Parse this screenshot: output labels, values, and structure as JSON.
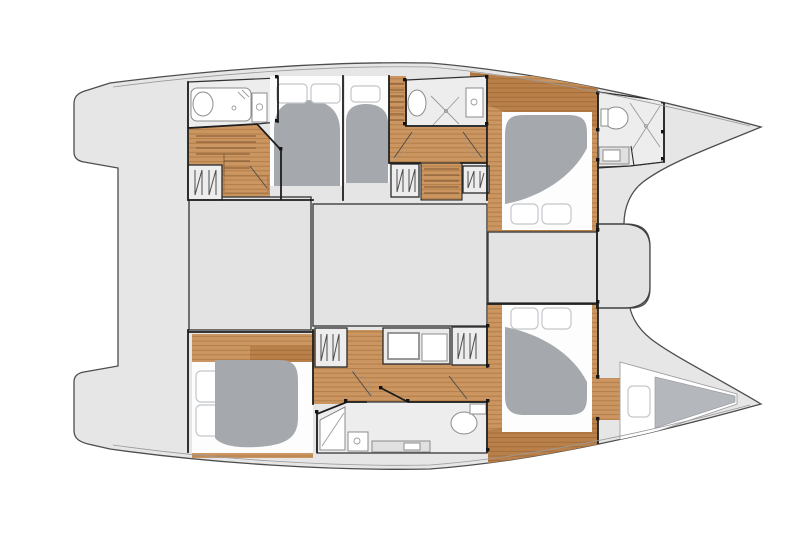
{
  "canvas": {
    "width": 800,
    "height": 533,
    "background": "#ffffff"
  },
  "diagram": {
    "type": "floor-plan",
    "subject": "catamaran yacht interior layout, top view, no text labels",
    "text_labels": [],
    "areas": {
      "bridgedeck": [
        "aft-platform",
        "salon-block-left",
        "salon-block-right",
        "forward-cockpit",
        "forward-beam"
      ],
      "port_hull": [
        "aft-head-shower",
        "aft-companionway-stairs",
        "hanging-locker-aft",
        "aft-double-cabin",
        "mid-single-cabin",
        "companionway-corridor",
        "mid-head-shower",
        "hanging-locker-left",
        "companionway-steps",
        "hanging-locker-right",
        "forward-cabin",
        "bow-head",
        "bow-peak"
      ],
      "starboard_hull": [
        "aft-double-cabin",
        "hanging-locker-aft",
        "companionway-corridor",
        "vanity-unit",
        "hanging-locker-fwd",
        "mid-head",
        "forward-cabin",
        "bow-v-berth",
        "bow-peak"
      ]
    }
  },
  "colors": {
    "background": "#ffffff",
    "hull": "#e6e6e6",
    "hullStroke": "#4d4d4d",
    "gunwale": "#9a9a9a",
    "deck": "#e5e5e5",
    "wall": "#1e1e1e",
    "wood": "#cb9661",
    "woodLine": "#b17a44",
    "woodDark": "#ba8049",
    "woodDarkLine": "#9f6a38",
    "duvet": "#a5a9ae",
    "duvetLight": "#b4b7bb",
    "mattress": "#fdfdfd",
    "window": "#ffffff",
    "windowStroke": "#c3c7cb",
    "bath": "#ededed",
    "fixtureStroke": "#8c8c8c",
    "block": "#e3e3e3",
    "blockStroke": "#3f3f3f",
    "locker": "#ededed",
    "hatch": "#4d4d4d",
    "step": "#7c5733",
    "door": "#4a4a4a",
    "hinge": "#141414"
  }
}
